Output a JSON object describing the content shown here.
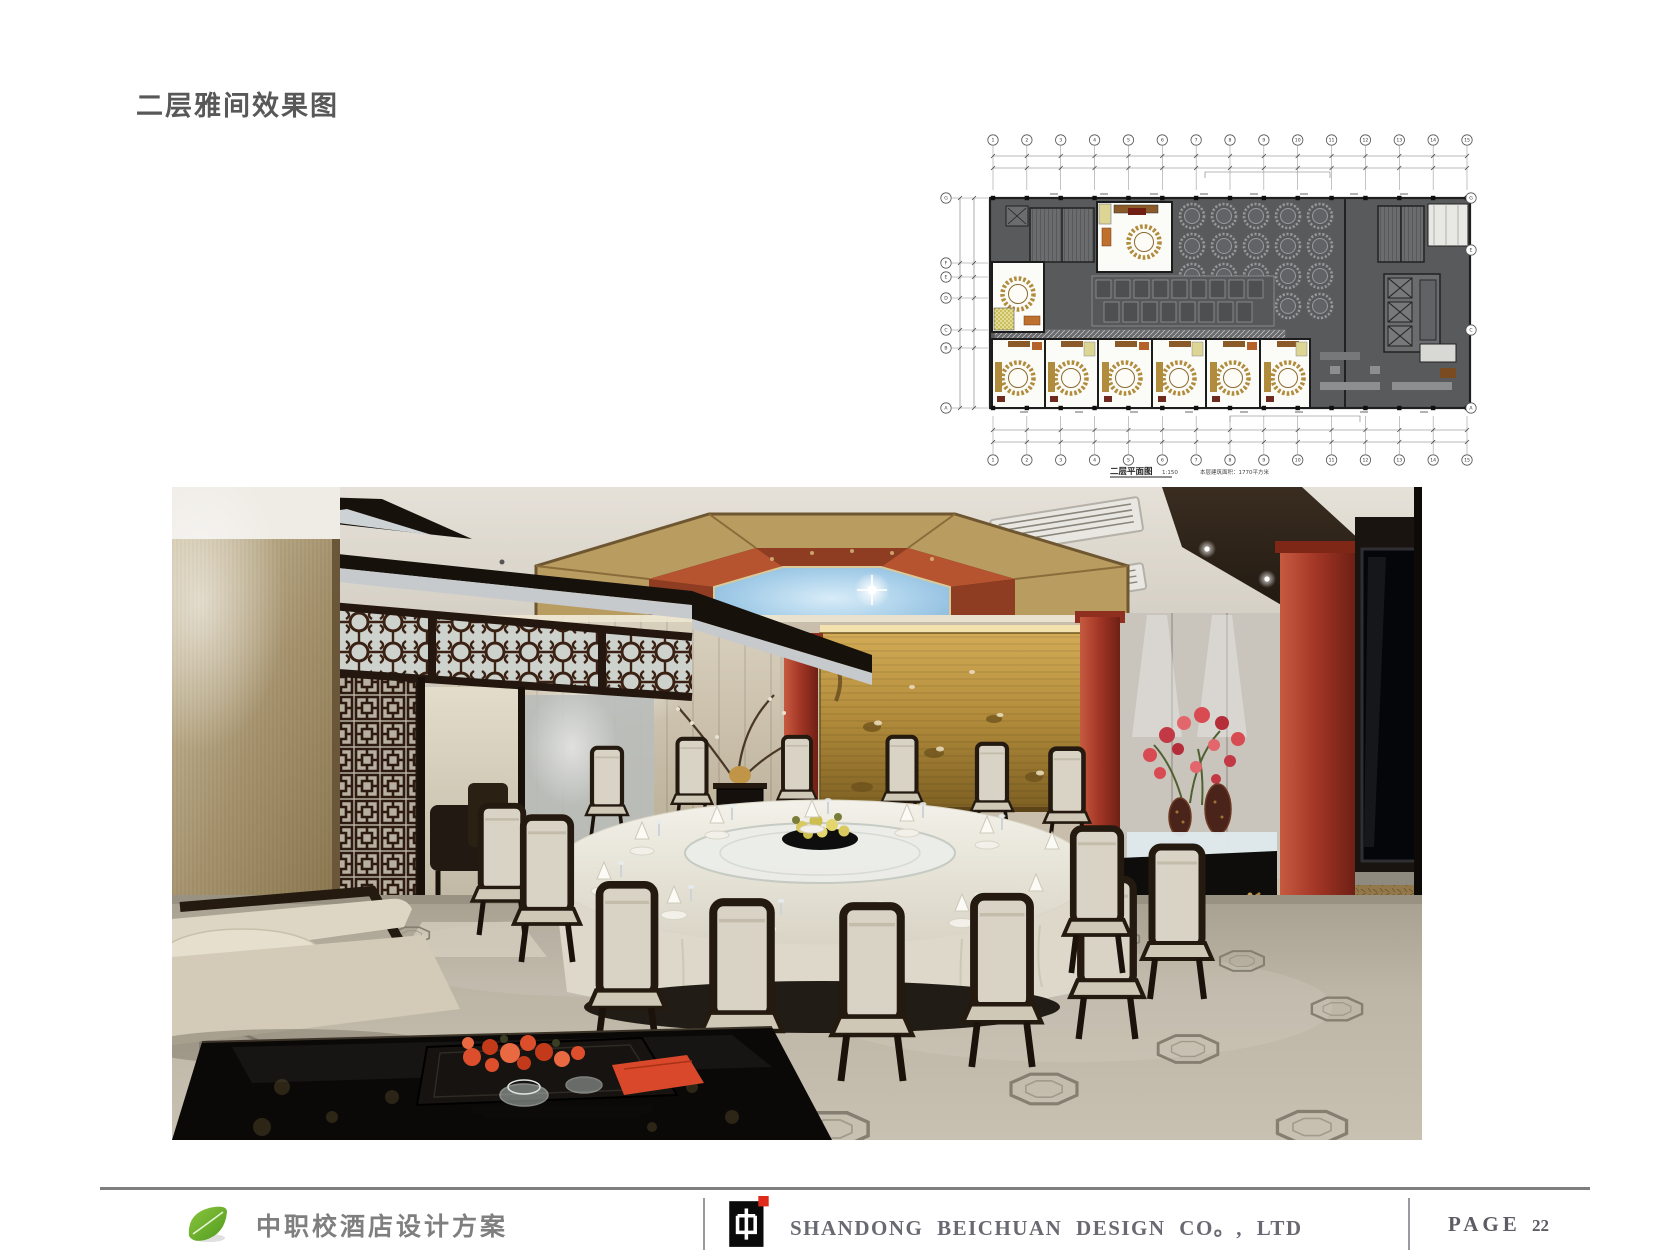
{
  "page": {
    "title": "二层雅间效果图"
  },
  "floor_plan": {
    "caption": "二层平面图",
    "scale": "1:150",
    "area_note": "本层建筑面积：1770平方米",
    "grid_top": [
      "1",
      "2",
      "3",
      "4",
      "5",
      "6",
      "7",
      "8",
      "9",
      "10",
      "11",
      "12",
      "13",
      "14",
      "15"
    ],
    "grid_bottom": [
      "1",
      "2",
      "3",
      "4",
      "5",
      "6",
      "7",
      "8",
      "9",
      "10",
      "11",
      "12",
      "13",
      "14",
      "15"
    ],
    "grid_left": [
      "G",
      "F",
      "E",
      "D",
      "C",
      "B",
      "A"
    ],
    "grid_right": [
      "G",
      "E",
      "C",
      "A"
    ]
  },
  "footer": {
    "project_name": "中职校酒店设计方案",
    "company": "SHANDONG  BEICHUAN  DESIGN  CO。, LTD",
    "page_label": "PAGE",
    "page_number": "22"
  },
  "colors": {
    "accent_red": "#a93b2a",
    "mural_gold": "#b8913d",
    "plan_wall_gray": "#595a5c",
    "footer_text": "#696972",
    "leaf_green": "#6fae2c"
  }
}
